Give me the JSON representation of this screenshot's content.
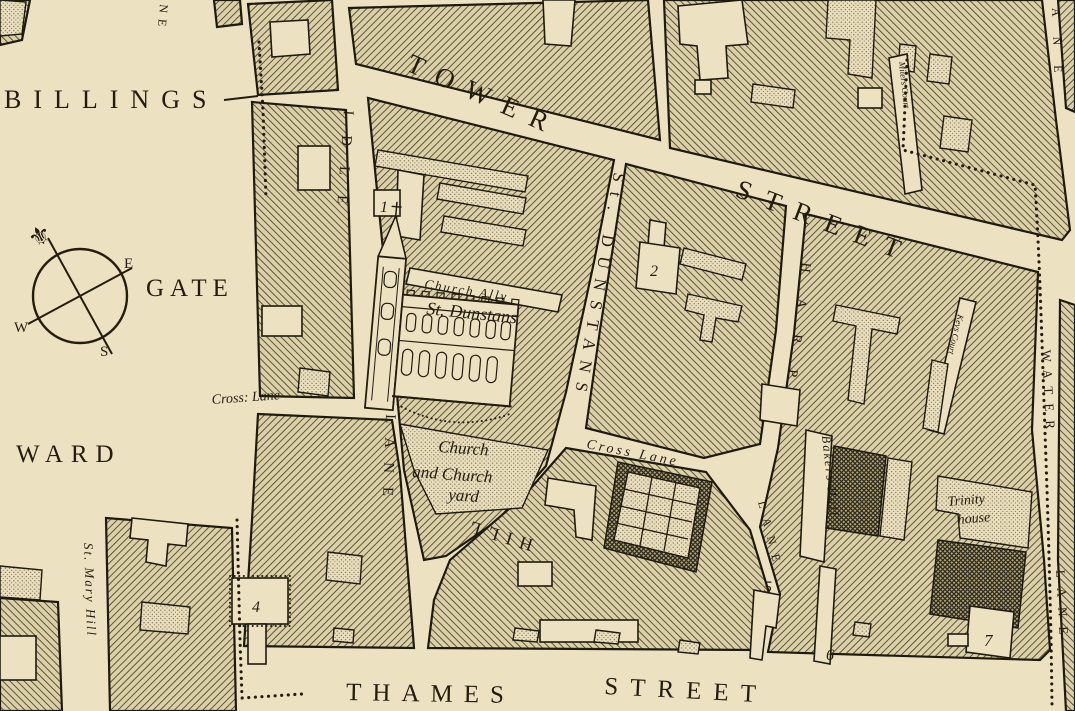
{
  "map": {
    "ward_labels": {
      "billings": "BILLINGS",
      "gate": "GATE",
      "ward": "WARD"
    },
    "streets": {
      "tower": "TOWER",
      "tower_street": "STREET",
      "thames": "THAMES",
      "thames_street": "STREET",
      "idle": "IDLE",
      "idle_lane": "LANE",
      "st_dunstans": "St. DUNSTANS",
      "hill": "HILL",
      "cross_lane_west": "Cross: Lane",
      "cross_lane_mid": "Cross Lane",
      "harp": "HARP",
      "harp_lane": "LANE",
      "water": "WATER",
      "water_lane": "LANE",
      "lane_partial_top_right": "ANE",
      "lane_partial_top_left": "NE",
      "st_mary_hill": "St. Mary Hill"
    },
    "places": {
      "church_ally": "Church Ally",
      "st_dunstans_church": "St. Dunstans",
      "churchyard_line1": "Church",
      "churchyard_line2": "and Church",
      "churchyard_line3": "yard",
      "bakers_hall": "Bakers Hall",
      "trinity_line1": "Trinity",
      "trinity_line2": "house",
      "miters_court": "Miters Court",
      "keys_court": "Keys Court"
    },
    "numbers": {
      "n1": "1",
      "n2": "2",
      "n4": "4",
      "n5": "5",
      "n6": "6",
      "n7": "7"
    },
    "compass": {
      "e": "E",
      "w": "W",
      "s": "S",
      "north_fleur": "⚜"
    },
    "colors": {
      "parchment": "#ece2c2",
      "ink": "#241d0e",
      "hatch_line": "#44402c",
      "stipple_dot": "#6f6449"
    }
  }
}
